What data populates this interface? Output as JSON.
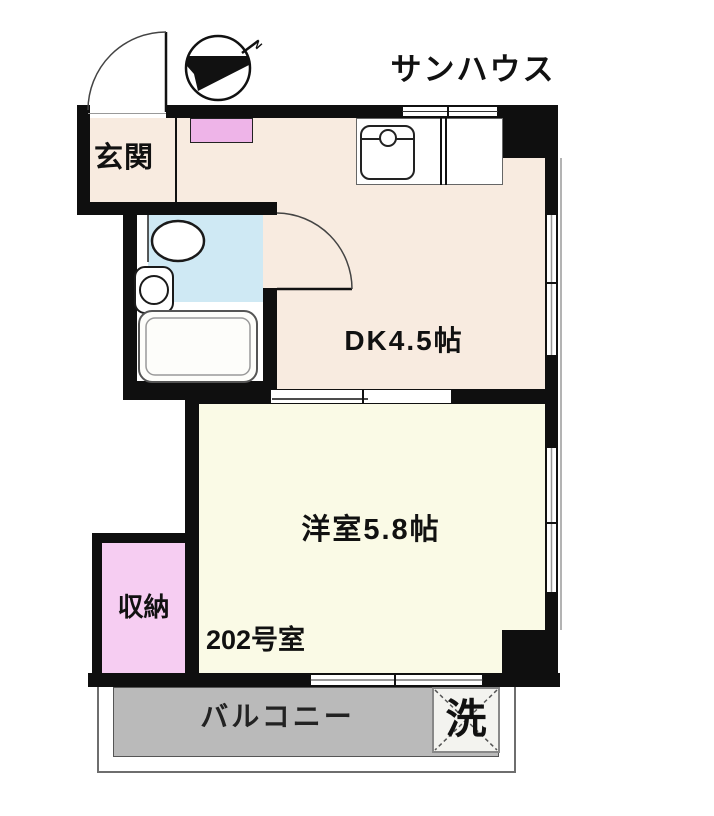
{
  "building": {
    "title": "サンハウス",
    "unit_label": "202号室"
  },
  "rooms": {
    "entrance": {
      "label": "玄関"
    },
    "dining_kitchen": {
      "label": "DK4.5帖"
    },
    "western_room": {
      "label": "洋室5.8帖"
    },
    "storage": {
      "label": "収納"
    },
    "balcony": {
      "label": "バルコニー"
    }
  },
  "fixtures": {
    "washing_machine": {
      "label": "洗"
    }
  },
  "compass": {
    "north_label": "N"
  },
  "colors": {
    "wall": "#0f0f0f",
    "dk_floor": "#f8ebe0",
    "western_floor": "#fafae6",
    "bath_blue": "#cfe9f4",
    "storage_pink": "#f6cdf2",
    "cabinet_pink": "#eeb4e8",
    "balcony_gray": "#bababa"
  }
}
